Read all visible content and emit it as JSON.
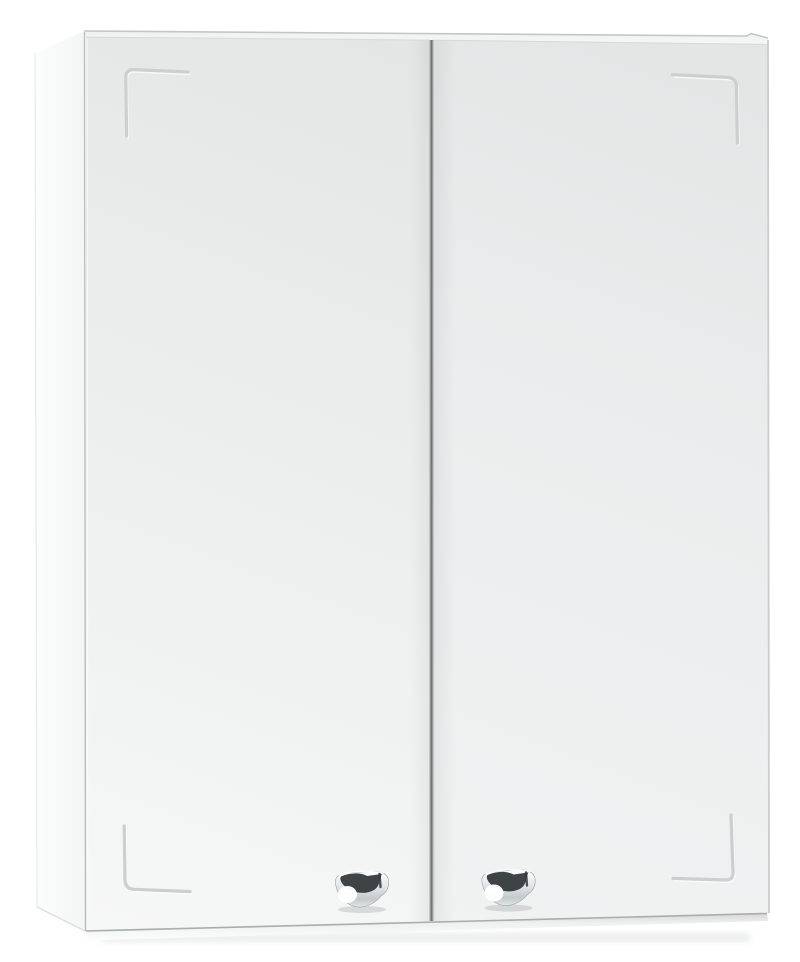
{
  "scene": {
    "description": "Product photo of a white wall-mounted cabinet with two doors, slightly angled view from the left",
    "object": "two-door wall cabinet",
    "door_count": 2,
    "handle_count": 2,
    "corner_groove_count": 4,
    "finish": "white",
    "handle_finish": "chrome"
  },
  "colors": {
    "background": "#ffffff",
    "side_panel_light": "#fcfdfd",
    "side_panel_dark": "#f3f5f5",
    "door_light": "#f6f7f7",
    "door_mid": "#ebedee",
    "door_dark": "#e4e6e6",
    "top_edge_fill": "#f6f8f8",
    "groove": "#cbcfcf",
    "door_gap": "#6f7575",
    "gap_penumbra": "#b7bcbc",
    "outline_edge": "#c2c6c6",
    "right_edge": "#c9cdcd",
    "bottom_shadow_line": "#a8adad",
    "chrome_dark": "#2f3437",
    "chrome_mid": "#c3c9cc",
    "chrome_light": "#ffffff",
    "drop_shadow": "#c9cdcd"
  }
}
